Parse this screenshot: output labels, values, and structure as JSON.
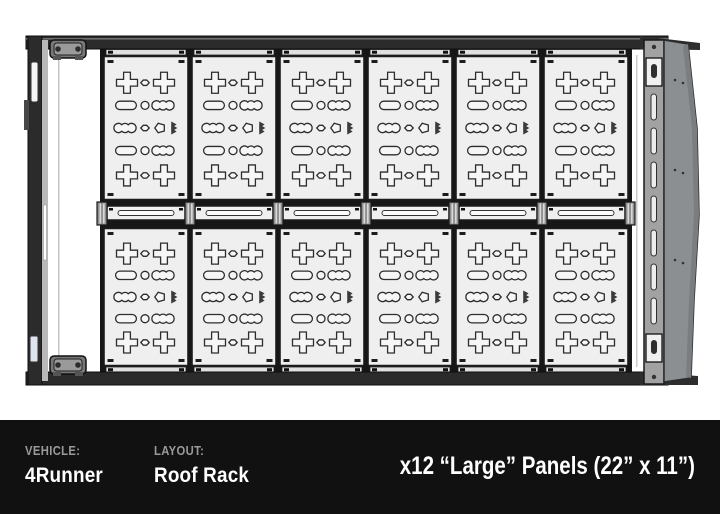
{
  "title": "Roof rack panel layout diagram",
  "diagram": {
    "view": "top-down-roof-rack",
    "panel_count": 12,
    "grid": {
      "columns": 6,
      "rows": 2
    },
    "panel_logo_icon": "mountain-peaks-icon",
    "parts": {
      "left_rail": "side-rail",
      "right_rail": "slotted-side-rail",
      "fairing": "wind-deflector-fairing",
      "clamps": "mounting-clamps",
      "crossbar": "slotted-crossbar"
    }
  },
  "footer": {
    "vehicle_label": "VEHICLE:",
    "vehicle_value": "4Runner",
    "layout_label": "LAYOUT:",
    "layout_value": "Roof Rack",
    "panel_spec": "x12 “Large” Panels (22” x 11”)"
  },
  "colors": {
    "background": "#ffffff",
    "footer_bg": "#111111",
    "footer_label": "#9a9a9a",
    "footer_value": "#ffffff",
    "panel_fill": "#efefef",
    "cutout_fill": "#f6f6f6",
    "panel_stroke": "#1c1c1c",
    "frame_dark": "#2b2b2b",
    "zone_dark": "#161616",
    "rail_gray": "#a2a2a2",
    "fairing_gray": "#8c8f91",
    "fairing_shade": "#7b7e80",
    "connector_gray": "#8f8f8f",
    "strip_light": "#e0e0e0",
    "logo_dark": "#3a3a3a"
  }
}
